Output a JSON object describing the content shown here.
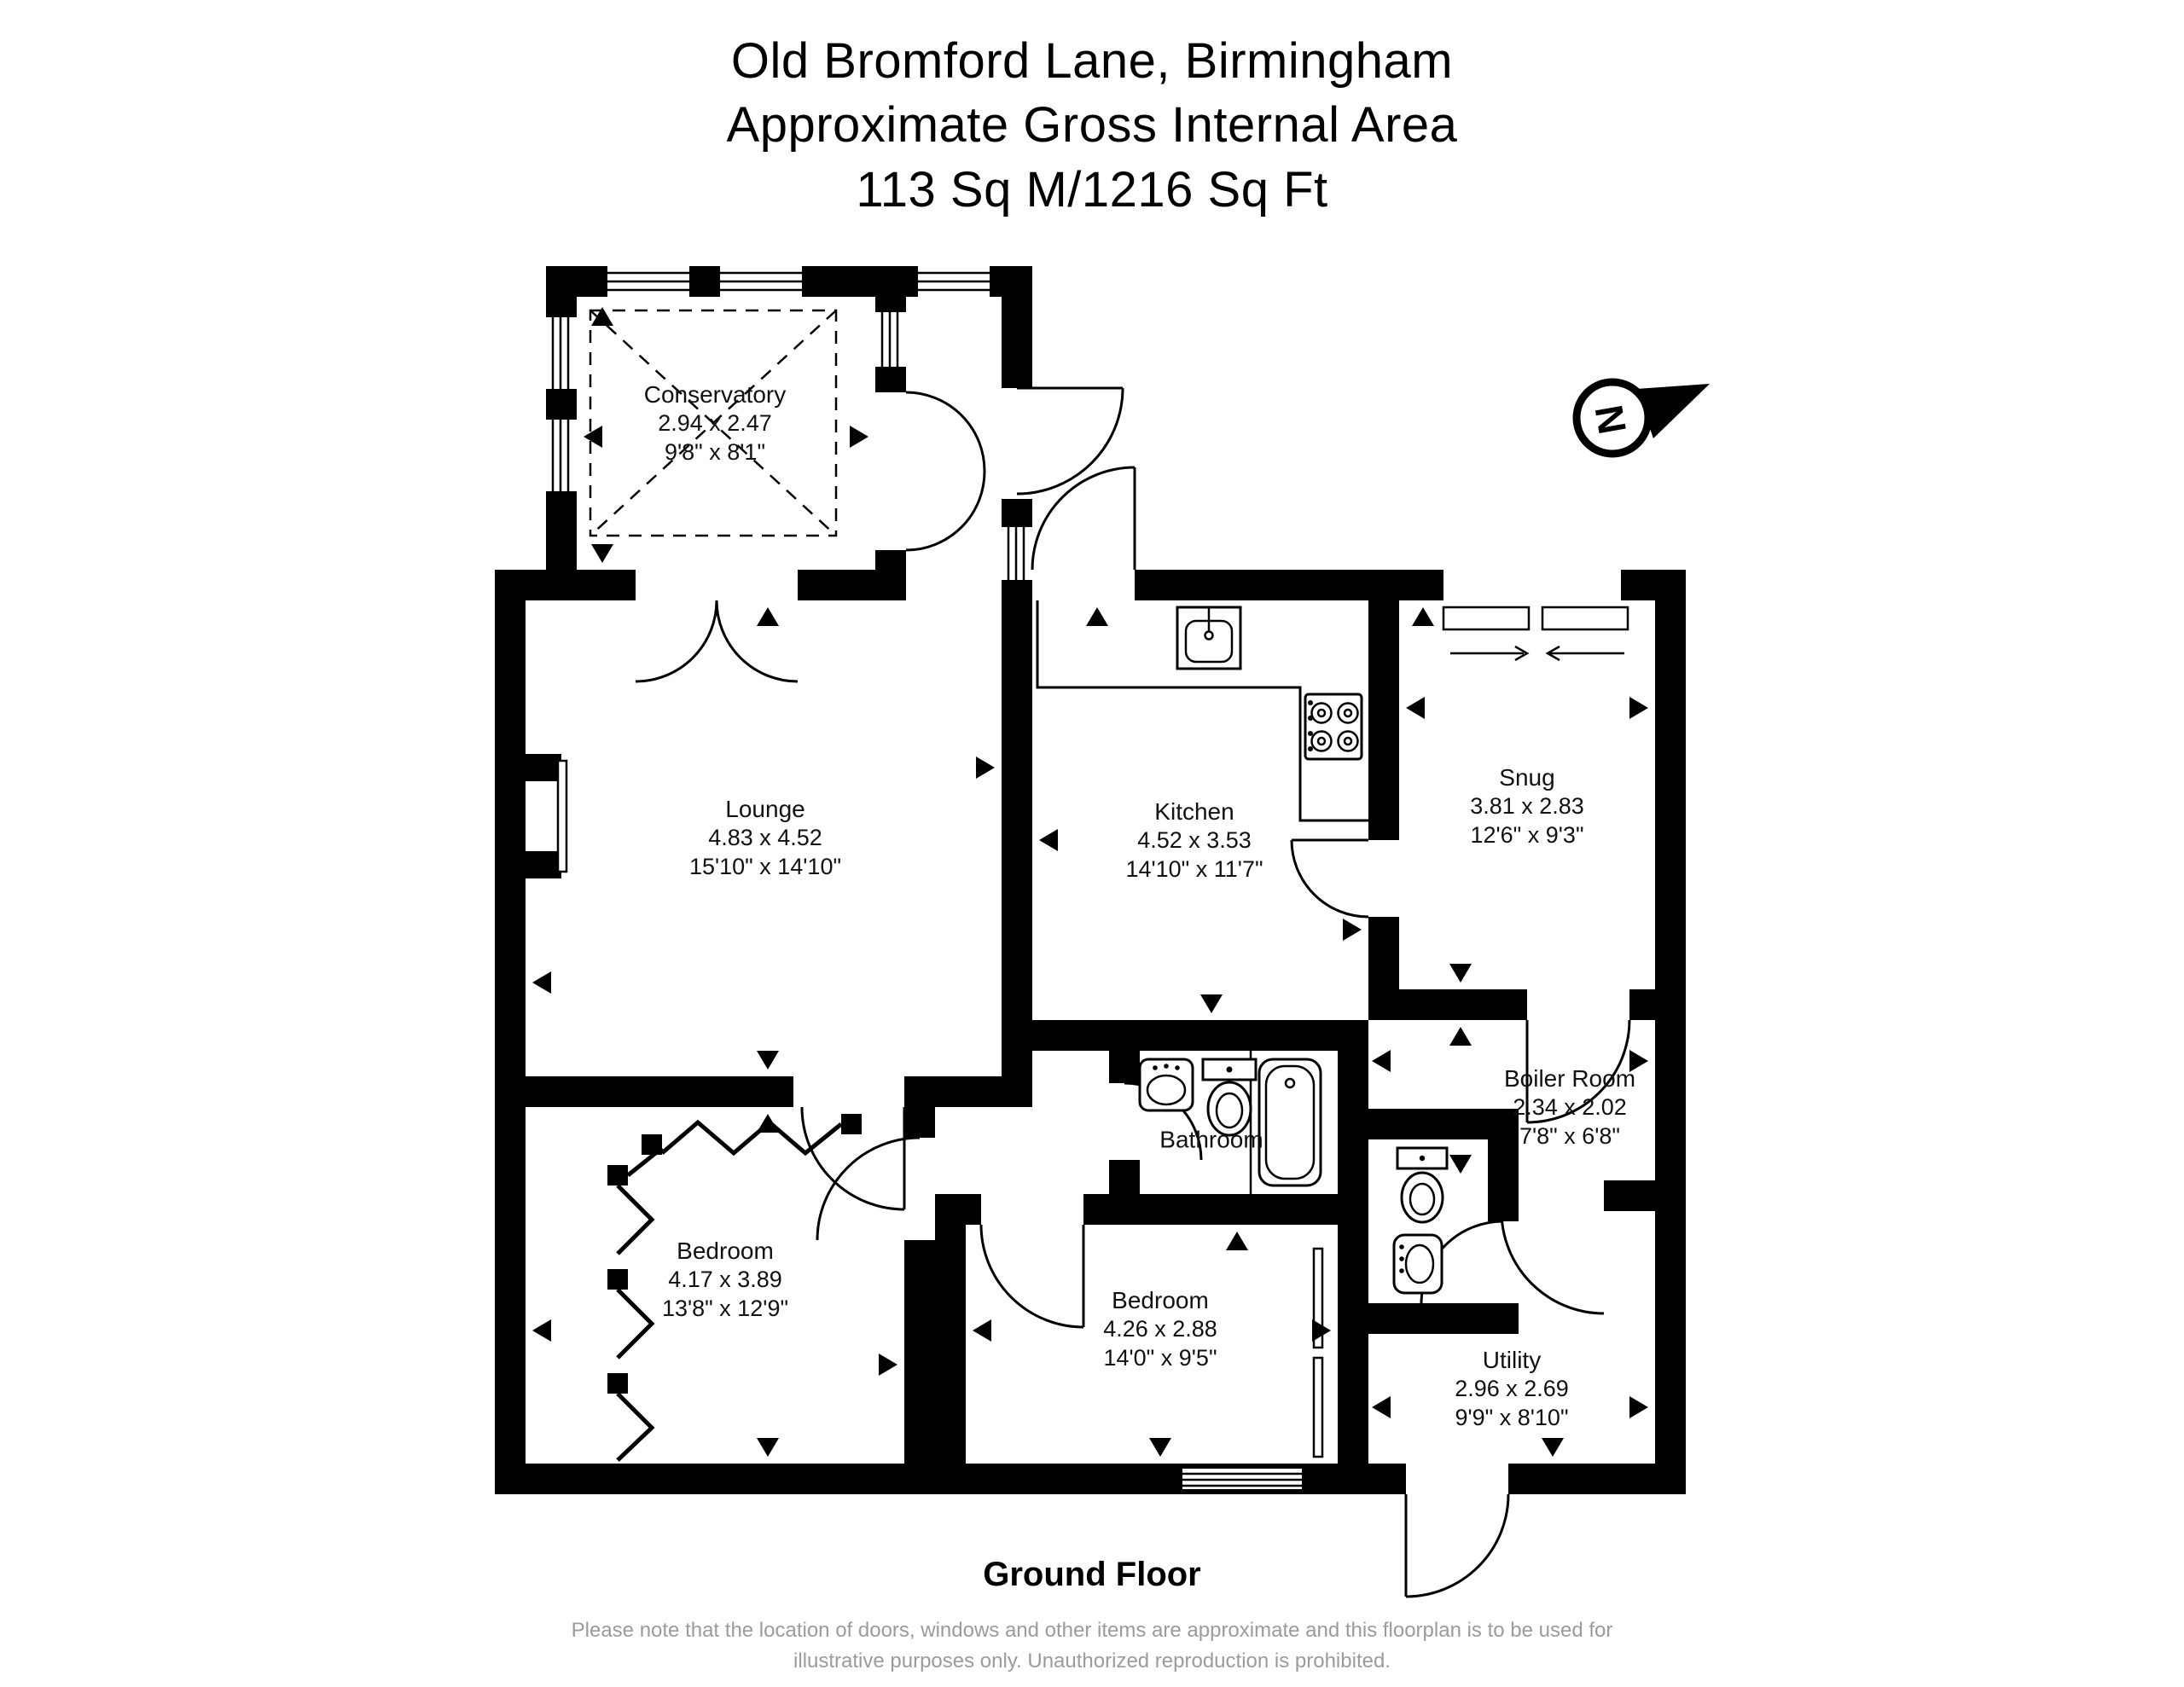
{
  "title": {
    "address": "Old Bromford Lane, Birmingham",
    "area_label": "Approximate Gross Internal Area",
    "area_value": "113 Sq M/1216 Sq Ft"
  },
  "floor_label": "Ground Floor",
  "disclaimer": "Please note that the location of doors, windows and other items are approximate and this floorplan is to be used for illustrative purposes only. Unauthorized reproduction is prohibited.",
  "compass": {
    "letter": "N"
  },
  "colors": {
    "wall": "#000000",
    "text": "#111111",
    "disclaimer_text": "#9b9b9b"
  },
  "rooms": [
    {
      "id": "conservatory",
      "name": "Conservatory",
      "metric": "2.94 x 2.47",
      "imperial": "9'8\" x 8'1\""
    },
    {
      "id": "lounge",
      "name": "Lounge",
      "metric": "4.83 x 4.52",
      "imperial": "15'10\" x 14'10\""
    },
    {
      "id": "kitchen",
      "name": "Kitchen",
      "metric": "4.52 x 3.53",
      "imperial": "14'10\" x 11'7\""
    },
    {
      "id": "snug",
      "name": "Snug",
      "metric": "3.81 x 2.83",
      "imperial": "12'6\" x 9'3\""
    },
    {
      "id": "bathroom",
      "name": "Bathroom"
    },
    {
      "id": "boiler-room",
      "name": "Boiler Room",
      "metric": "2.34 x 2.02",
      "imperial": "7'8\" x 6'8\""
    },
    {
      "id": "bedroom-1",
      "name": "Bedroom",
      "metric": "4.17 x 3.89",
      "imperial": "13'8\" x 12'9\""
    },
    {
      "id": "bedroom-2",
      "name": "Bedroom",
      "metric": "4.26 x 2.88",
      "imperial": "14'0\" x 9'5\""
    },
    {
      "id": "utility",
      "name": "Utility",
      "metric": "2.96 x 2.69",
      "imperial": "9'9\" x 8'10\""
    }
  ]
}
